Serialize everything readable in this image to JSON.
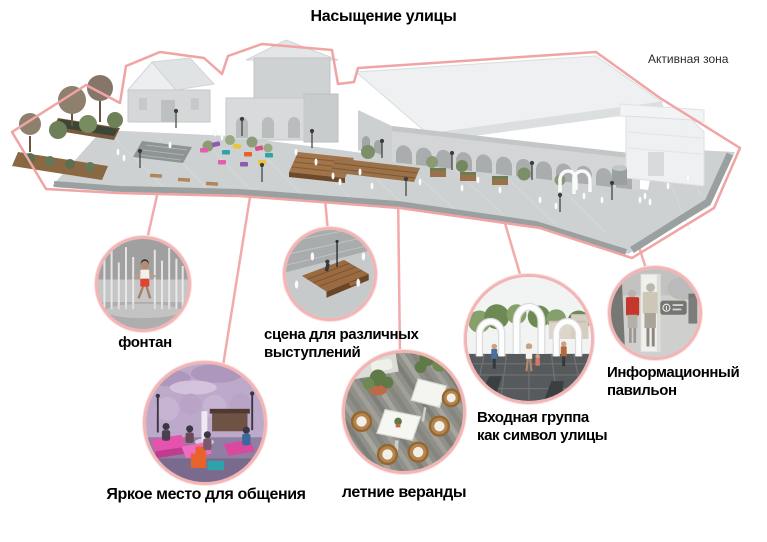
{
  "title": "Насыщение улицы",
  "legend": {
    "active_zone": "Активная зона"
  },
  "callouts": {
    "fountain": {
      "label": "фонтан"
    },
    "stage": {
      "label": "сцена для различных\nвыступлений"
    },
    "bright_place": {
      "label": "Яркое место для общения"
    },
    "verandas": {
      "label": "летние веранды"
    },
    "entrance": {
      "label": "Входная группа\nкак символ улицы"
    },
    "info_pavilion": {
      "label": "Информационный\nпавильон"
    }
  },
  "colors": {
    "site_outline_pink": "#f0a4a4",
    "callout_ring_pink": "#f3b4b4",
    "leader_line_pink": "#f2abab",
    "label_text": "#000000",
    "building_gray": "#d5d7d8",
    "roof_white": "#eef0f1",
    "pavement_gray": "#cdd1d1"
  }
}
